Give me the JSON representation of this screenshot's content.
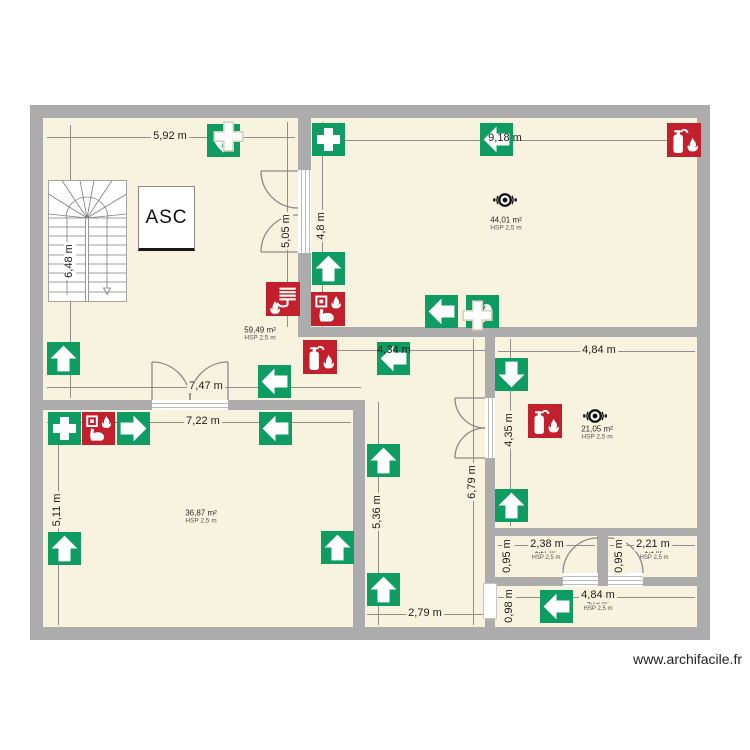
{
  "meta": {
    "type": "floor-plan",
    "watermark": "www.archifacile.fr"
  },
  "colors": {
    "floor": "#F8F3DF",
    "wall": "#ACACAC",
    "safety_green": "#0F9C62",
    "safety_red": "#C2202C",
    "alarm_black": "#111111"
  },
  "labels": {
    "elevator": "ASC"
  },
  "dimensions": [
    {
      "id": "hall-top-width",
      "text": "5,92 m"
    },
    {
      "id": "hall-left-height",
      "text": "6,48 m"
    },
    {
      "id": "room44-top-width",
      "text": "9,18 m"
    },
    {
      "id": "room44-left-height",
      "text": "4,8 m"
    },
    {
      "id": "hall-right-height",
      "text": "5,05 m"
    },
    {
      "id": "corridor-band-width",
      "text": "7,47 m"
    },
    {
      "id": "corridor-link-width",
      "text": "4,34 m"
    },
    {
      "id": "room36-top-width",
      "text": "7,22 m"
    },
    {
      "id": "room36-left-height",
      "text": "5,11 m"
    },
    {
      "id": "corridor-mid-height",
      "text": "5,36 m"
    },
    {
      "id": "corridor-bottom-width",
      "text": "2,79 m"
    },
    {
      "id": "corridor-right-height",
      "text": "6,79 m"
    },
    {
      "id": "room21-top-width",
      "text": "4,84 m"
    },
    {
      "id": "room21-left-height",
      "text": "4,35 m"
    },
    {
      "id": "closet1-width",
      "text": "2,38 m"
    },
    {
      "id": "closet1-height",
      "text": "0,95 m"
    },
    {
      "id": "closet2-width",
      "text": "2,21 m"
    },
    {
      "id": "closet2-height",
      "text": "0,95 m"
    },
    {
      "id": "bottomroom-width",
      "text": "4,84 m"
    },
    {
      "id": "bottomroom-height",
      "text": "0,98 m"
    }
  ],
  "rooms": [
    {
      "id": "hall-stairs",
      "area": "59,49 m²",
      "hsp": "HSP 2,5 m"
    },
    {
      "id": "top-right-room",
      "area": "44,01 m²",
      "hsp": "HSP 2,5 m"
    },
    {
      "id": "bottom-left-room",
      "area": "36,87 m²",
      "hsp": "HSP 2,5 m"
    },
    {
      "id": "mid-right-room",
      "area": "21,05 m²",
      "hsp": "HSP 2,5 m"
    },
    {
      "id": "closet-1",
      "area": "2,27 m²",
      "hsp": "HSP 2,5 m"
    },
    {
      "id": "closet-2",
      "area": "2,1 m²",
      "hsp": "HSP 2,5 m"
    },
    {
      "id": "bottom-right-room",
      "area": "4,75 m²",
      "hsp": "HSP 2,5 m"
    }
  ],
  "icons": [
    {
      "name": "defibrillator-icon",
      "color": "green",
      "location": "hall-top"
    },
    {
      "name": "first-aid-cross-icon",
      "color": "green",
      "location": "room44-top-left"
    },
    {
      "name": "exit-arrow-left-icon",
      "color": "green",
      "location": "room44-top"
    },
    {
      "name": "fire-extinguisher-icon",
      "color": "red",
      "location": "room44-top-right"
    },
    {
      "name": "exit-arrow-up-icon",
      "color": "green",
      "location": "room44-left"
    },
    {
      "name": "exit-arrow-left-icon",
      "color": "green",
      "location": "room44-bottom"
    },
    {
      "name": "defibrillator-icon",
      "color": "green",
      "location": "room44-bottom"
    },
    {
      "name": "alarm-sounder-icon",
      "color": "black",
      "location": "room44-center"
    },
    {
      "name": "fire-hose-reel-icon",
      "color": "red",
      "location": "hall-wall"
    },
    {
      "name": "manual-call-point-icon",
      "color": "red",
      "location": "hall-wall"
    },
    {
      "name": "fire-extinguisher-icon",
      "color": "red",
      "location": "corridor-band"
    },
    {
      "name": "exit-arrow-left-icon",
      "color": "green",
      "location": "corridor-band"
    },
    {
      "name": "exit-arrow-up-icon",
      "color": "green",
      "location": "corridor-band-left"
    },
    {
      "name": "exit-arrow-left-icon",
      "color": "green",
      "location": "corridor-link"
    },
    {
      "name": "exit-arrow-down-icon",
      "color": "green",
      "location": "room21-top-left"
    },
    {
      "name": "fire-extinguisher-icon",
      "color": "red",
      "location": "room21-center"
    },
    {
      "name": "alarm-sounder-icon",
      "color": "black",
      "location": "room21-center"
    },
    {
      "name": "exit-arrow-up-icon",
      "color": "green",
      "location": "room21-bottom-left"
    },
    {
      "name": "exit-arrow-up-icon",
      "color": "green",
      "location": "corridor-mid"
    },
    {
      "name": "exit-arrow-up-icon",
      "color": "green",
      "location": "corridor-bottom"
    },
    {
      "name": "first-aid-cross-icon",
      "color": "green",
      "location": "room36-top-left"
    },
    {
      "name": "manual-call-point-icon",
      "color": "red",
      "location": "room36-top-left"
    },
    {
      "name": "exit-arrow-right-icon",
      "color": "green",
      "location": "room36-top-left"
    },
    {
      "name": "exit-arrow-left-icon",
      "color": "green",
      "location": "room36-top"
    },
    {
      "name": "exit-arrow-up-icon",
      "color": "green",
      "location": "room36-bottom-left"
    },
    {
      "name": "exit-arrow-up-icon",
      "color": "green",
      "location": "room36-bottom-right"
    },
    {
      "name": "exit-arrow-left-icon",
      "color": "green",
      "location": "bottom-right-room"
    }
  ]
}
